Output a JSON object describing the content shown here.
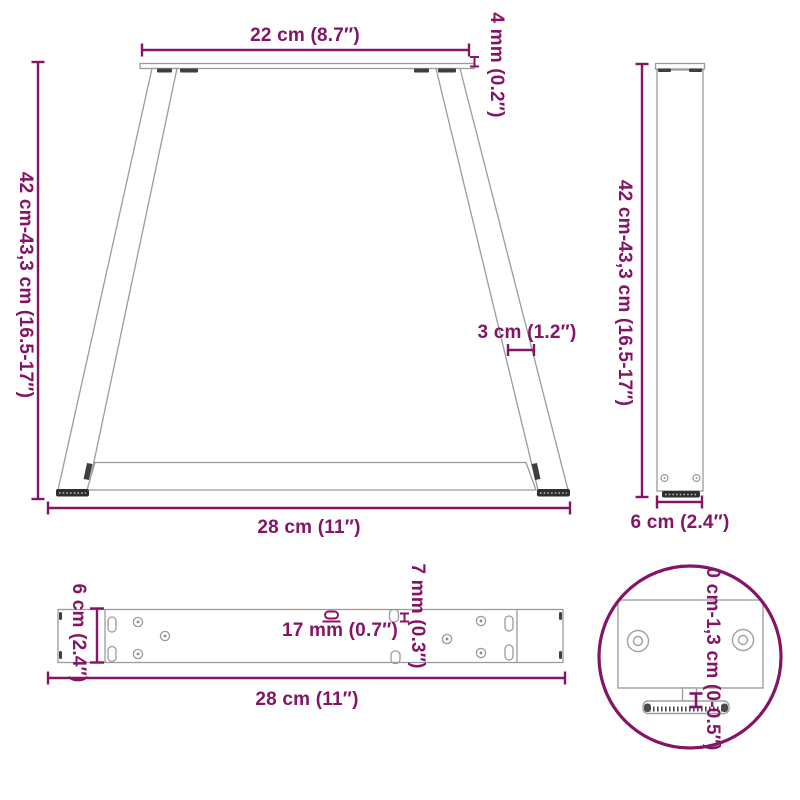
{
  "colors": {
    "dimension_accent": "#841465",
    "outline_light": "#9B9B9B",
    "outline_dark": "#3F3F3F"
  },
  "views": {
    "front": {
      "top_width": "22 cm (8.7″)",
      "plate_thickness": "4 mm (0.2″)",
      "height": "42 cm-43,3 cm (16.5-17″)",
      "leg_width": "3 cm (1.2″)",
      "bottom_width": "28 cm (11″)"
    },
    "side": {
      "height": "42 cm-43,3 cm (16.5-17″)",
      "depth": "6 cm (2.4″)"
    },
    "top": {
      "depth": "6 cm (2.4″)",
      "slot_length": "17 mm (0.7″)",
      "slot_width": "7 mm (0.3″)",
      "width": "28 cm (11″)"
    },
    "detail": {
      "adjustable_range": "0 cm-1,3 cm (0-0.5″)"
    }
  }
}
